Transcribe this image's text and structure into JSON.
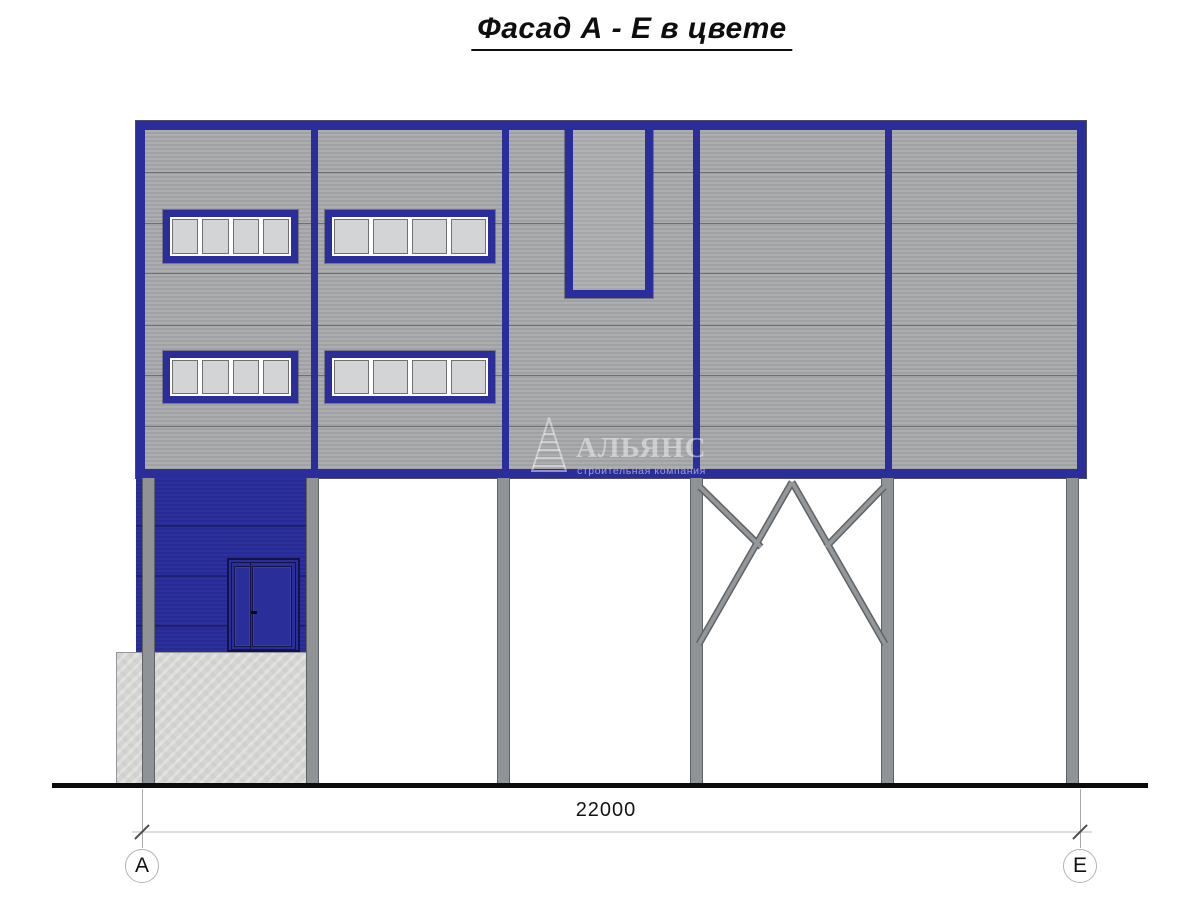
{
  "title": "Фасад А - Е в цвете",
  "watermark": {
    "name": "АЛЬЯНС",
    "tagline": "строительная компания",
    "logo_icon": "sail-triangle-icon"
  },
  "dimension": {
    "overall_width": "22000"
  },
  "axes": [
    {
      "label": "А"
    },
    {
      "label": "Е"
    }
  ],
  "colors": {
    "frame_blue": "#2b2d9b",
    "wall_blue": "#2a2e99",
    "panel_gray": "#a6a7a9",
    "column_gray": "#8f9396",
    "concrete_gray": "#d5d5d3",
    "glass_gray": "#d3d4d6",
    "ground_black": "#0b0b0b",
    "dimension_line_gray": "#dedede"
  }
}
